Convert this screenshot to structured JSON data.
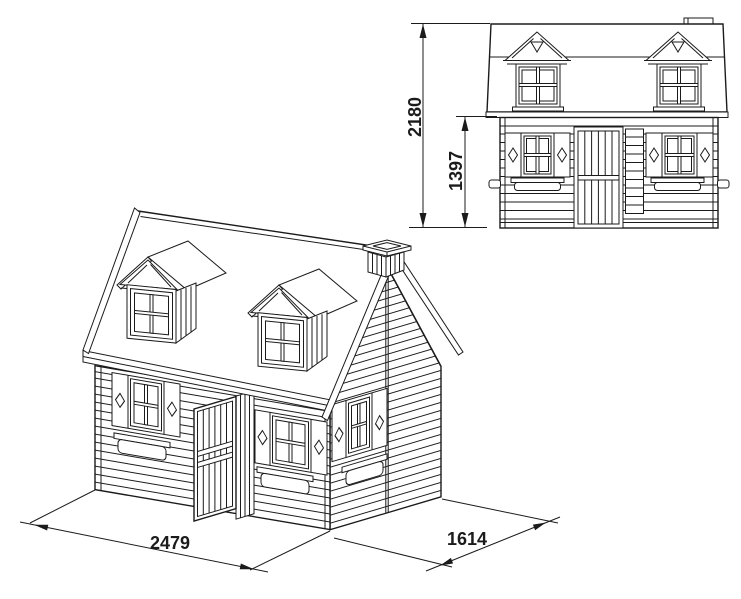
{
  "front_elevation": {
    "overall_height": "2180",
    "eave_height": "1397"
  },
  "isometric_view": {
    "front_width": "2479",
    "side_depth": "1614"
  }
}
